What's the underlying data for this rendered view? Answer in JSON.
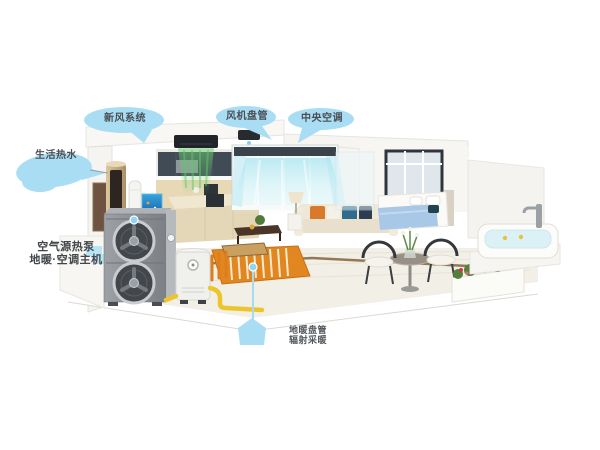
{
  "labels": {
    "hot_water": "生活热水",
    "fresh_air": "新风系统",
    "fan_coil": "风机盘管",
    "central_ac": "中央空调",
    "heat_pump_line1": "空气源热泵",
    "heat_pump_line2": "地暖·空调主机",
    "floor_heating_line1": "地暖盘管",
    "floor_heating_line2": "辐射采暖"
  },
  "colors": {
    "label_bubble": "#a9ddf4",
    "label_text": "#4b4f54",
    "airflow_green": "#5ec968",
    "airflow_cyan": "#aee9f2",
    "pipe_yellow": "#ecc52c",
    "floor_heating_orange": "#e2861f",
    "outdoor_unit_gray": "#8a8e92",
    "hot_tank_gold": "#c9b189",
    "marker_blue": "#8ed7f2",
    "background": "#ffffff"
  }
}
